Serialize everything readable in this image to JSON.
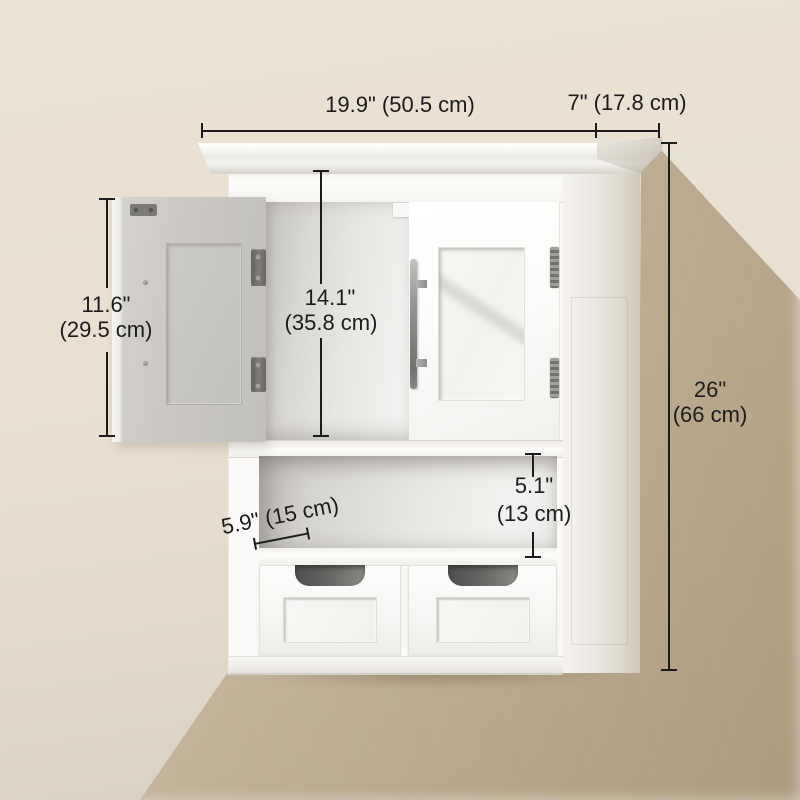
{
  "scene": {
    "subject": "White wall-mounted bathroom cabinet: left door open (gray inner face), right shaker door with vertical bar handle, open middle shelf, two bottom drawers with cutout pulls, crown molding top"
  },
  "dimensions": {
    "top_width": {
      "label": "19.9\" (50.5 cm)"
    },
    "top_depth": {
      "label": "7\" (17.8 cm)"
    },
    "left_door_height": {
      "line1": "11.6\"",
      "line2": "(29.5 cm)"
    },
    "interior_height": {
      "line1": "14.1\"",
      "line2": "(35.8 cm)"
    },
    "overall_height": {
      "line1": "26\"",
      "line2": "(66 cm)"
    },
    "open_shelf_height": {
      "line1": "5.1\"",
      "line2": "(13 cm)"
    },
    "shelf_depth": {
      "label": "5.9\" (15 cm)"
    }
  },
  "colors": {
    "wall": "#e9e1d3",
    "wall_shadow": "#c7b391",
    "cabinet_white": "#fbfaf8",
    "open_door_gray": "#ccc9c5",
    "hardware_metal": "#7b7975",
    "drawer_cutout": "#5c5b59",
    "dimension_ink": "#1c1c1c"
  }
}
